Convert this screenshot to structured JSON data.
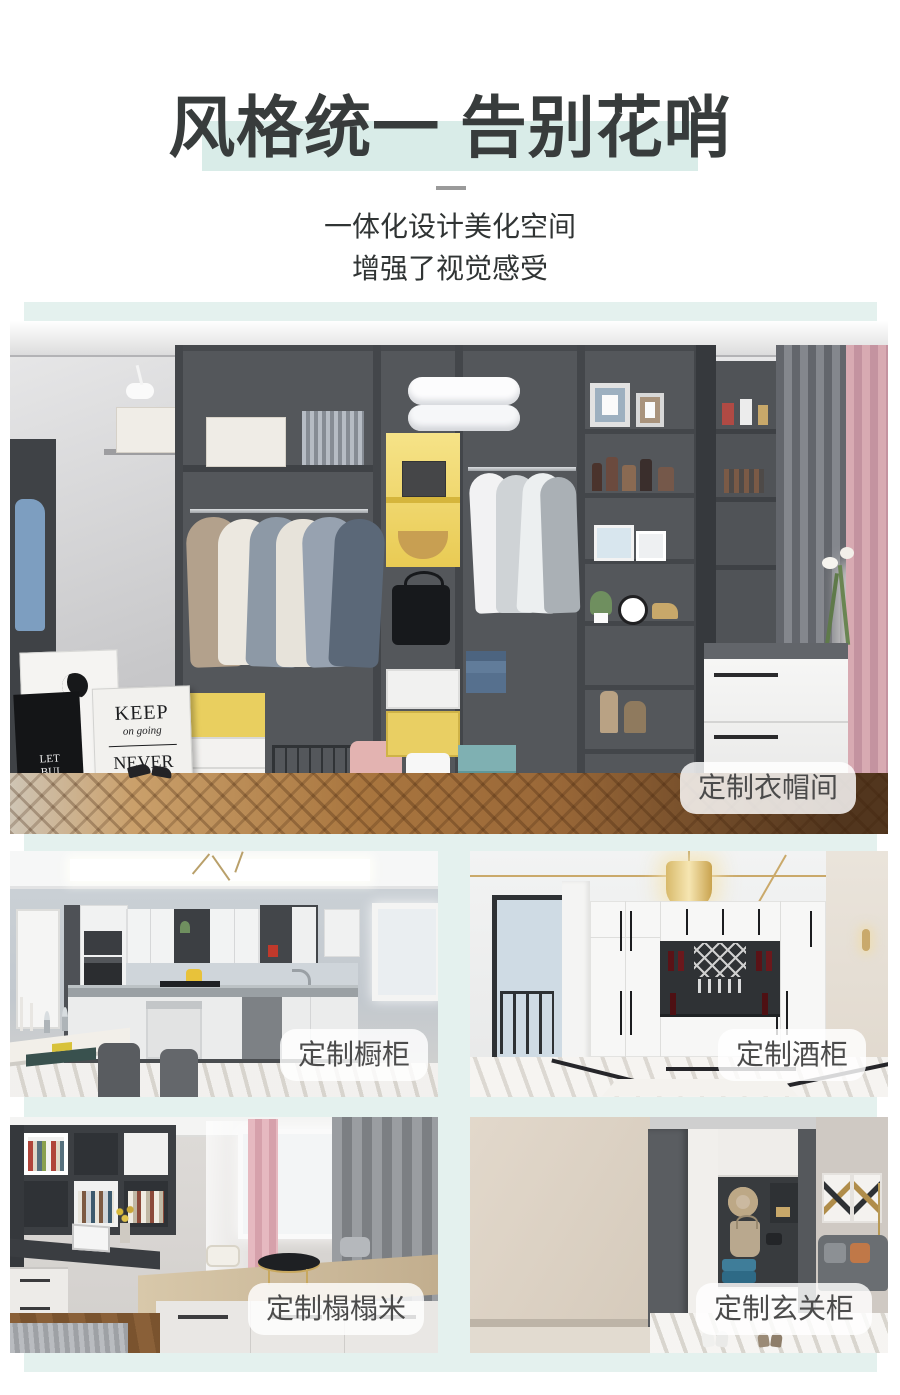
{
  "theme": {
    "title_color": "#383c3c",
    "title_highlight": "#d9ece8",
    "collage_backdrop": "#e4f1ee",
    "pill_background": "rgba(255,255,255,0.82)",
    "pill_text_color": "#4b4b4b"
  },
  "header": {
    "title": "风格统一 告别花哨",
    "subtitle_line1": "一体化设计美化空间",
    "subtitle_line2": "增强了视觉感受"
  },
  "gallery": {
    "hero_label": "定制衣帽间",
    "kitchen_label": "定制橱柜",
    "wine_label": "定制酒柜",
    "tatami_label": "定制榻榻米",
    "entry_label": "定制玄关柜"
  },
  "hero_scene": {
    "poster_keep_line1": "KEEP",
    "poster_keep_line2": "on going",
    "poster_keep_line3": "NEVER",
    "poster_keep_line4": "give up",
    "poster_side_line1": "LET",
    "poster_side_line2": "BUI"
  }
}
